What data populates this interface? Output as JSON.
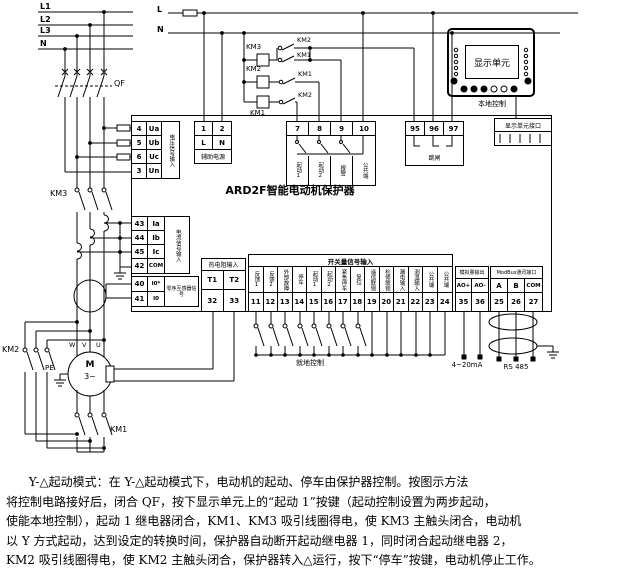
{
  "power": {
    "bus1": "L1",
    "bus2": "L2",
    "bus3": "L3",
    "bus4": "N",
    "breaker": "QF",
    "km3": "KM3",
    "km2": "KM2",
    "km1": "KM1",
    "motor": {
      "m": "M",
      "phase": "3~",
      "pe": "PE",
      "t1": "W",
      "t2": "V",
      "t3": "U"
    }
  },
  "control": {
    "l": "L",
    "n": "N",
    "coil1": "KM3",
    "coil2": "KM2",
    "coil3": "KM1",
    "aux1_up": "KM2",
    "aux1_dn": "KM1",
    "aux2": "KM1",
    "aux3": "KM2"
  },
  "protector": {
    "title": "ARD2F智能电动机保护器",
    "voltage": {
      "label": "电压信号输入",
      "rows": [
        [
          "4",
          "Ua"
        ],
        [
          "5",
          "Ub"
        ],
        [
          "6",
          "Uc"
        ],
        [
          "3",
          "Un"
        ]
      ]
    },
    "aux_power": {
      "label": "辅助电源",
      "cols": [
        [
          "1",
          "L"
        ],
        [
          "2",
          "N"
        ]
      ]
    },
    "relay_out": {
      "nums": [
        "7",
        "8",
        "9",
        "10"
      ],
      "labels": [
        "起动1",
        "起动2",
        "报警",
        "公共端"
      ]
    },
    "trip": {
      "nums": [
        "95",
        "96",
        "97"
      ],
      "label": "跳闸"
    },
    "interface": {
      "label": "显示单元接口"
    },
    "current": {
      "label": "电流信号输入",
      "rows": [
        [
          "43",
          "Ia"
        ],
        [
          "44",
          "Ib"
        ],
        [
          "45",
          "Ic"
        ],
        [
          "42",
          "COM"
        ]
      ]
    },
    "leakage": {
      "label": "零序互感器信号",
      "rows": [
        [
          "40",
          "I0*"
        ],
        [
          "41",
          "I0"
        ]
      ]
    },
    "temp": {
      "header": "热电阻输入",
      "syms": [
        "T1",
        "T2"
      ],
      "nums": [
        "32",
        "33"
      ]
    },
    "di": {
      "header": "开关量信号输入",
      "cols": [
        [
          "11",
          "反馈1"
        ],
        [
          "12",
          "反馈2"
        ],
        [
          "13",
          "外部故障"
        ],
        [
          "14",
          "停车"
        ],
        [
          "15",
          "起动1"
        ],
        [
          "16",
          "起动2"
        ],
        [
          "17",
          "紧急停车"
        ],
        [
          "18",
          "复位"
        ],
        [
          "19",
          "遥信联锁"
        ],
        [
          "20",
          "检修联锁"
        ],
        [
          "21",
          "漏电输入"
        ],
        [
          "22",
          "测温输入"
        ],
        [
          "23",
          "公共端"
        ],
        [
          "24",
          "公共端"
        ]
      ]
    },
    "analog": {
      "header": "模拟量输出",
      "syms": [
        "AO+",
        "AO-"
      ],
      "nums": [
        "35",
        "36"
      ],
      "note": "4~20mA"
    },
    "modbus": {
      "header": "ModBus通讯接口",
      "syms": [
        "A",
        "B",
        "COM"
      ],
      "nums": [
        "25",
        "26",
        "27"
      ],
      "note": "RS 485"
    }
  },
  "display_unit": {
    "screen": "显示单元",
    "local": "本地控制"
  },
  "annotations": {
    "local_ctrl": "就地控制"
  },
  "paragraph": {
    "lines": [
      "Y-△起动模式：在 Y-△起动模式下，电动机的起动、停车由保护器控制。按图示方法",
      "将控制电路接好后，闭合 QF，按下显示单元上的“起动 1”按键（起动控制设置为两步起动，",
      "使能本地控制），起动 1 继电器闭合，KM1、KM3 吸引线圈得电，使 KM3 主触头闭合，电动机",
      "以 Y 方式起动，达到设定的转换时间，保护器自动断开起动继电器 1，同时闭合起动继电器 2，",
      "KM2 吸引线圈得电，使 KM2 主触头闭合，保护器转入△运行，按下“停车”按键，电动机停止工作。"
    ]
  }
}
